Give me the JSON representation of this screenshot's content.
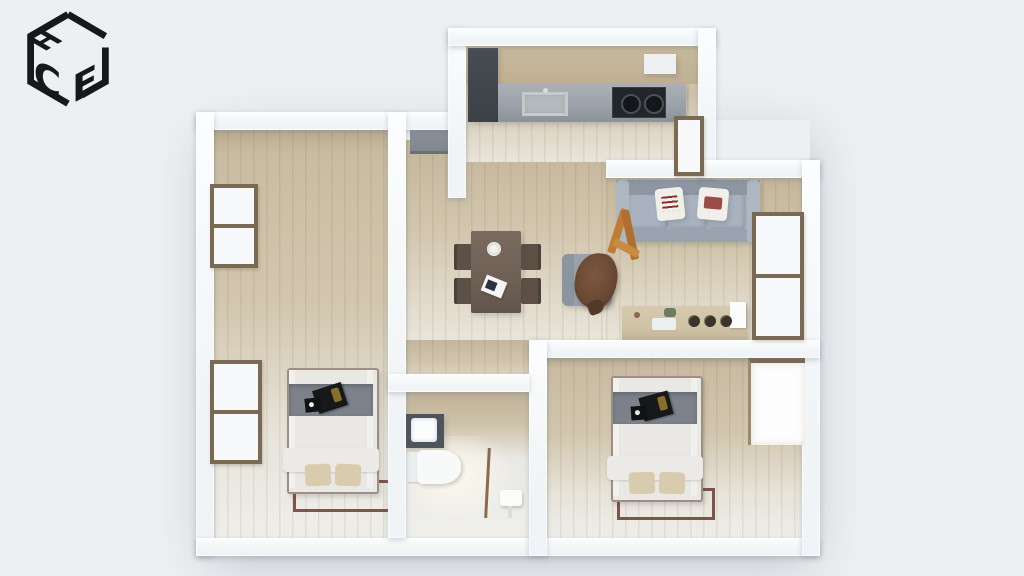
{
  "app": {
    "logo_letters": {
      "top": "H",
      "left": "C",
      "right": "F"
    }
  },
  "colors": {
    "bg": "#edeff2",
    "wall": "#f1f4f6",
    "wood": "#d2c6ae",
    "wood-dark": "#c4b69b",
    "wood-pale": "#e9e5da",
    "floor-pale": "#e9e8e4",
    "counter": "#9aa1a8",
    "cabinet-dark": "#3c4147",
    "cooktop": "#22252a",
    "sofa": "#a3adb9",
    "sofa-dark": "#8d97a4",
    "pillow": "#f1efe9",
    "pillow-print": "#8d2f2a",
    "table": "#6e6055",
    "chair": "#5d5147",
    "armchair": "#99a2ac",
    "fur": "#6b4a34",
    "console": "#cfc2a5",
    "mattress": "#e9e8e5",
    "bed-band": "#7c818a",
    "bed-pillow": "#d9ccae",
    "bed-frame": "#5f4538",
    "rug": "#6b3a30",
    "window-frame": "#7b6a53",
    "glass": "#f7f8f9",
    "door": "#7e858c",
    "fixture-dark": "#4e545b",
    "white": "#fbfcfc",
    "orange": "#c07b35"
  },
  "scene": {
    "type": "3d-floorplan-top-view",
    "rooms": [
      {
        "name": "kitchen"
      },
      {
        "name": "living-room"
      },
      {
        "name": "dining-area"
      },
      {
        "name": "entry-hall"
      },
      {
        "name": "bathroom"
      },
      {
        "name": "bedroom-left"
      },
      {
        "name": "bedroom-right"
      }
    ],
    "furniture": [
      {
        "name": "kitchen-counter-with-sink"
      },
      {
        "name": "cooktop"
      },
      {
        "name": "tall-cabinet"
      },
      {
        "name": "dining-table-with-four-chairs"
      },
      {
        "name": "plate"
      },
      {
        "name": "magazine"
      },
      {
        "name": "sofa-with-two-printed-pillows"
      },
      {
        "name": "armchair-with-fur-throw"
      },
      {
        "name": "wooden-decor-object"
      },
      {
        "name": "console-sideboard-with-bowls"
      },
      {
        "name": "double-bed-left"
      },
      {
        "name": "double-bed-right"
      },
      {
        "name": "bathroom-vanity-with-mirror"
      },
      {
        "name": "toilet"
      },
      {
        "name": "small-bath-fixture"
      },
      {
        "name": "front-door"
      },
      {
        "name": "windows",
        "count": 5
      }
    ]
  }
}
